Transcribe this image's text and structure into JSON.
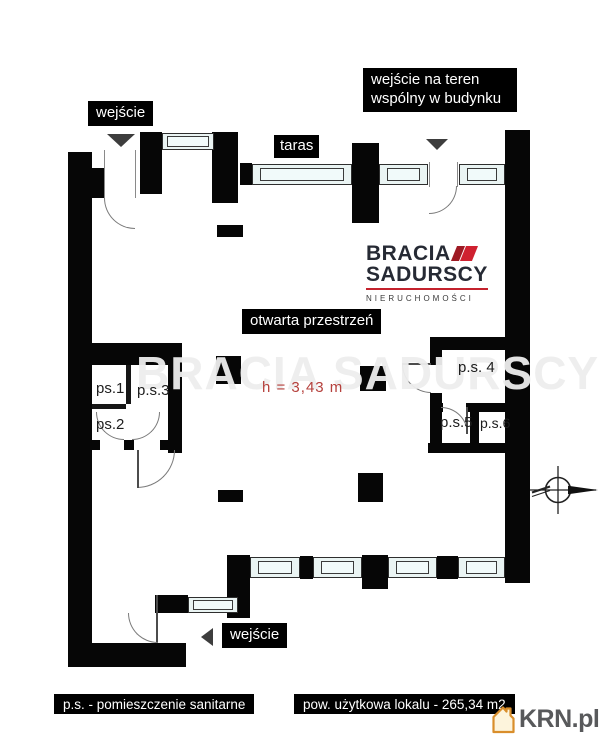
{
  "plan": {
    "labels": {
      "entrance_top": "wejście",
      "entrance_common": "wejście na teren wspólny w budynku",
      "terrace": "taras",
      "open_space": "otwarta przestrzeń",
      "ceiling_height": "h = 3,43 m",
      "entrance_bottom": "wejście"
    },
    "rooms": {
      "ps1": "ps.1",
      "ps2": "ps.2",
      "ps3": "p.s.3",
      "ps4": "p.s. 4",
      "ps5": "p.s.5",
      "ps6": "p.s.6"
    },
    "legend": {
      "sanitary_note": "p.s. - pomieszczenie sanitarne",
      "usable_area": "pow. użytkowa lokalu - 265,34 m2"
    }
  },
  "branding": {
    "agency_name_line1": "BRACIA",
    "agency_name_line2": "SADURSCY",
    "agency_subtitle": "NIERUCHOMOŚCI",
    "watermark_text": "BRACIA SADURSCY",
    "portal_name": "KRN.pl"
  },
  "colors": {
    "wall": "#060606",
    "window_glass": "#eaf4f3",
    "label_background": "#000000",
    "label_text": "#ffffff",
    "height_text": "#b5403c",
    "agency_text": "#262a34",
    "agency_accent": "#cf2130",
    "portal_text": "#58595b",
    "portal_icon": "#d98e2b"
  }
}
